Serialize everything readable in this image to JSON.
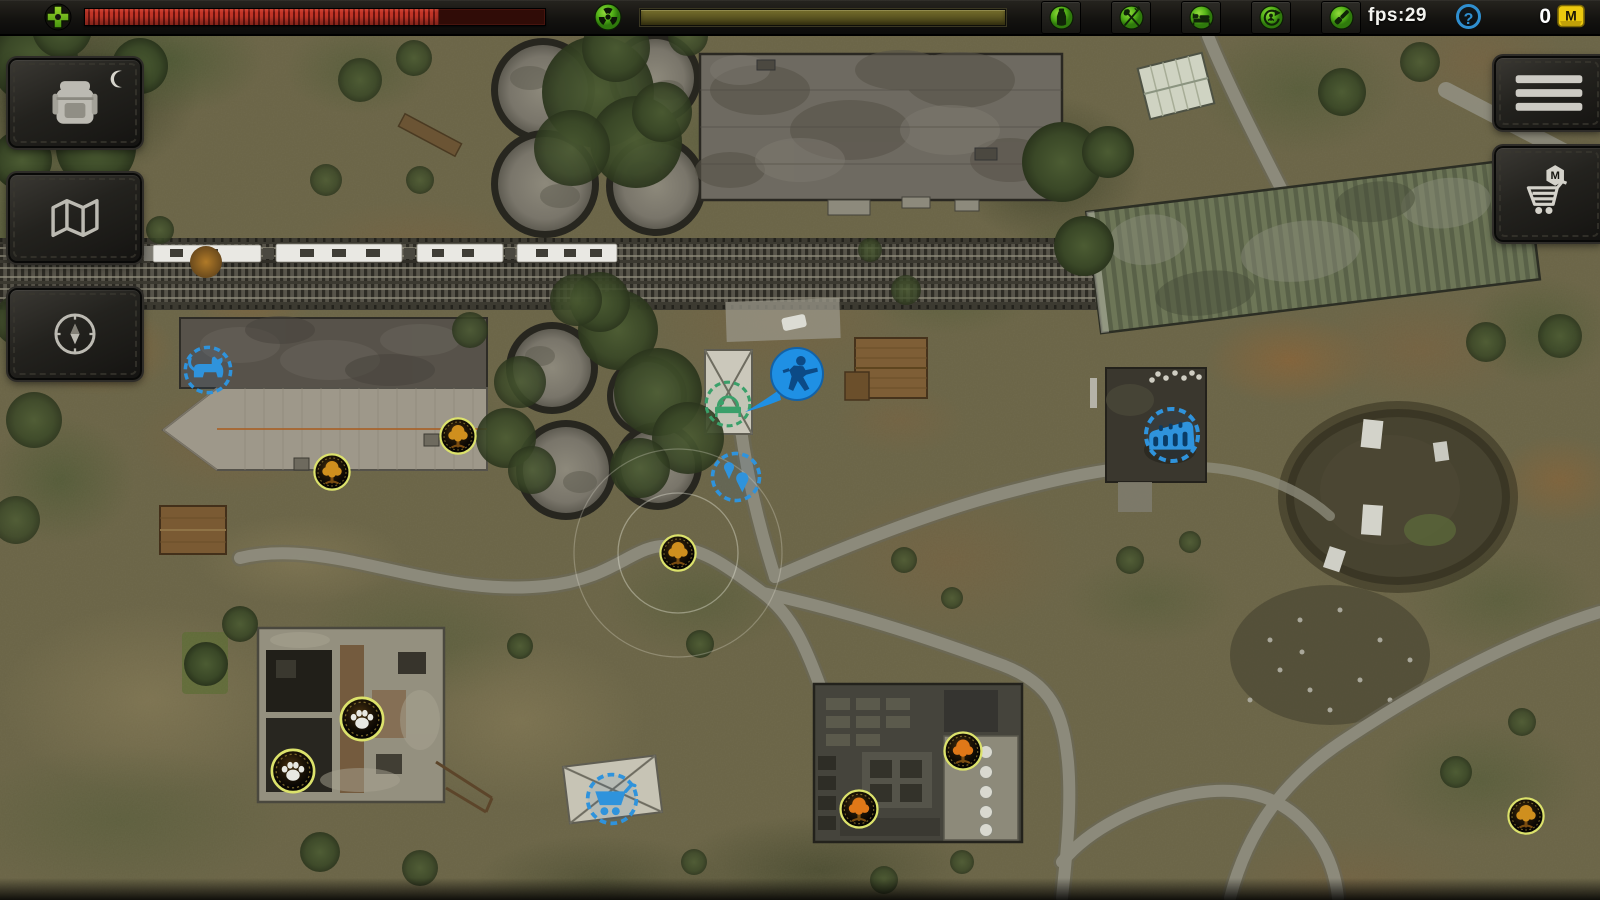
{
  "hud": {
    "health": {
      "icon": "health-cross-icon",
      "percent": 77
    },
    "radiation": {
      "icon": "radiation-icon",
      "percent": 100
    },
    "status_icons": [
      {
        "name": "thirst-status-icon",
        "glyph": "bottle"
      },
      {
        "name": "hunger-status-icon",
        "glyph": "cutlery"
      },
      {
        "name": "sleep-status-icon",
        "glyph": "bed"
      },
      {
        "name": "fatigue-status-icon",
        "glyph": "cycle"
      },
      {
        "name": "gear-status-icon",
        "glyph": "tool"
      }
    ],
    "fps_label": "fps:29",
    "help_label": "?",
    "currency": {
      "value": "0",
      "letter": "M",
      "icon": "m-box-icon"
    }
  },
  "left_toolbar": [
    {
      "name": "inventory-button",
      "icon": "backpack-icon",
      "badge_icon": "moon-icon"
    },
    {
      "name": "map-button",
      "icon": "map-icon"
    },
    {
      "name": "navigation-button",
      "icon": "compass-icon"
    }
  ],
  "right_toolbar": [
    {
      "name": "menu-button",
      "icon": "hamburger-icon"
    },
    {
      "name": "shop-button",
      "icon": "cart-shop-icon",
      "badge_letter": "M"
    }
  ],
  "colors": {
    "hud_green": "#5fc41f",
    "health_red": "#c43628",
    "radiation_olive": "#57511f",
    "marker_yellow_ring": "#dce26b",
    "marker_blue": "#2f93dc",
    "marker_green": "#3aa06a",
    "player_blue": "#1f90e4",
    "forage_amber": "#cf8f1e",
    "forage_orange": "#e07818"
  },
  "map": {
    "markers": [
      {
        "name": "animal-area-marker",
        "icon": "cat-icon",
        "style": "blue-dashed",
        "x": 208,
        "y": 370,
        "size": 54,
        "icon_scale": 1.1
      },
      {
        "name": "forage-marker-1",
        "icon": "tree-icon",
        "style": "stamp",
        "x": 458,
        "y": 436,
        "size": 40,
        "color": "#cf8f1e"
      },
      {
        "name": "forage-marker-2",
        "icon": "tree-icon",
        "style": "stamp",
        "x": 332,
        "y": 472,
        "size": 40,
        "color": "#cf8f1e"
      },
      {
        "name": "forage-marker-3",
        "icon": "tree-icon",
        "style": "stamp",
        "x": 678,
        "y": 553,
        "size": 40,
        "color": "#cf8f1e",
        "halo": true
      },
      {
        "name": "forage-marker-4",
        "icon": "tree-icon",
        "style": "stamp",
        "x": 963,
        "y": 751,
        "size": 42,
        "color": "#e07818"
      },
      {
        "name": "forage-marker-5",
        "icon": "tree-icon",
        "style": "stamp",
        "x": 859,
        "y": 809,
        "size": 42,
        "color": "#e07818"
      },
      {
        "name": "forage-marker-6",
        "icon": "tree-icon",
        "style": "stamp",
        "x": 1526,
        "y": 816,
        "size": 40,
        "color": "#cf8f1e"
      },
      {
        "name": "animal-tracks-marker-1",
        "icon": "paw-icon",
        "style": "stamp",
        "x": 362,
        "y": 719,
        "size": 48,
        "color": "#e8e8e2"
      },
      {
        "name": "animal-tracks-marker-2",
        "icon": "paw-icon",
        "style": "stamp",
        "x": 293,
        "y": 771,
        "size": 48,
        "color": "#e8e8e2"
      },
      {
        "name": "sleep-spot-marker",
        "icon": "bed-icon",
        "style": "green-dashed",
        "x": 728,
        "y": 404,
        "size": 52
      },
      {
        "name": "player-marker",
        "icon": "soldier-icon",
        "style": "player",
        "x": 795,
        "y": 374,
        "size": 58
      },
      {
        "name": "travel-points-marker",
        "icon": "pins-icon",
        "style": "blue-dashed",
        "x": 736,
        "y": 477,
        "size": 56
      },
      {
        "name": "ruins-marker",
        "icon": "ruins-icon",
        "style": "blue-dashed",
        "x": 1172,
        "y": 435,
        "size": 62,
        "icon_scale": 1.05
      },
      {
        "name": "trader-marker",
        "icon": "cart-icon",
        "style": "blue-dashed",
        "x": 612,
        "y": 799,
        "size": 58,
        "icon_scale": 1.05
      }
    ]
  }
}
